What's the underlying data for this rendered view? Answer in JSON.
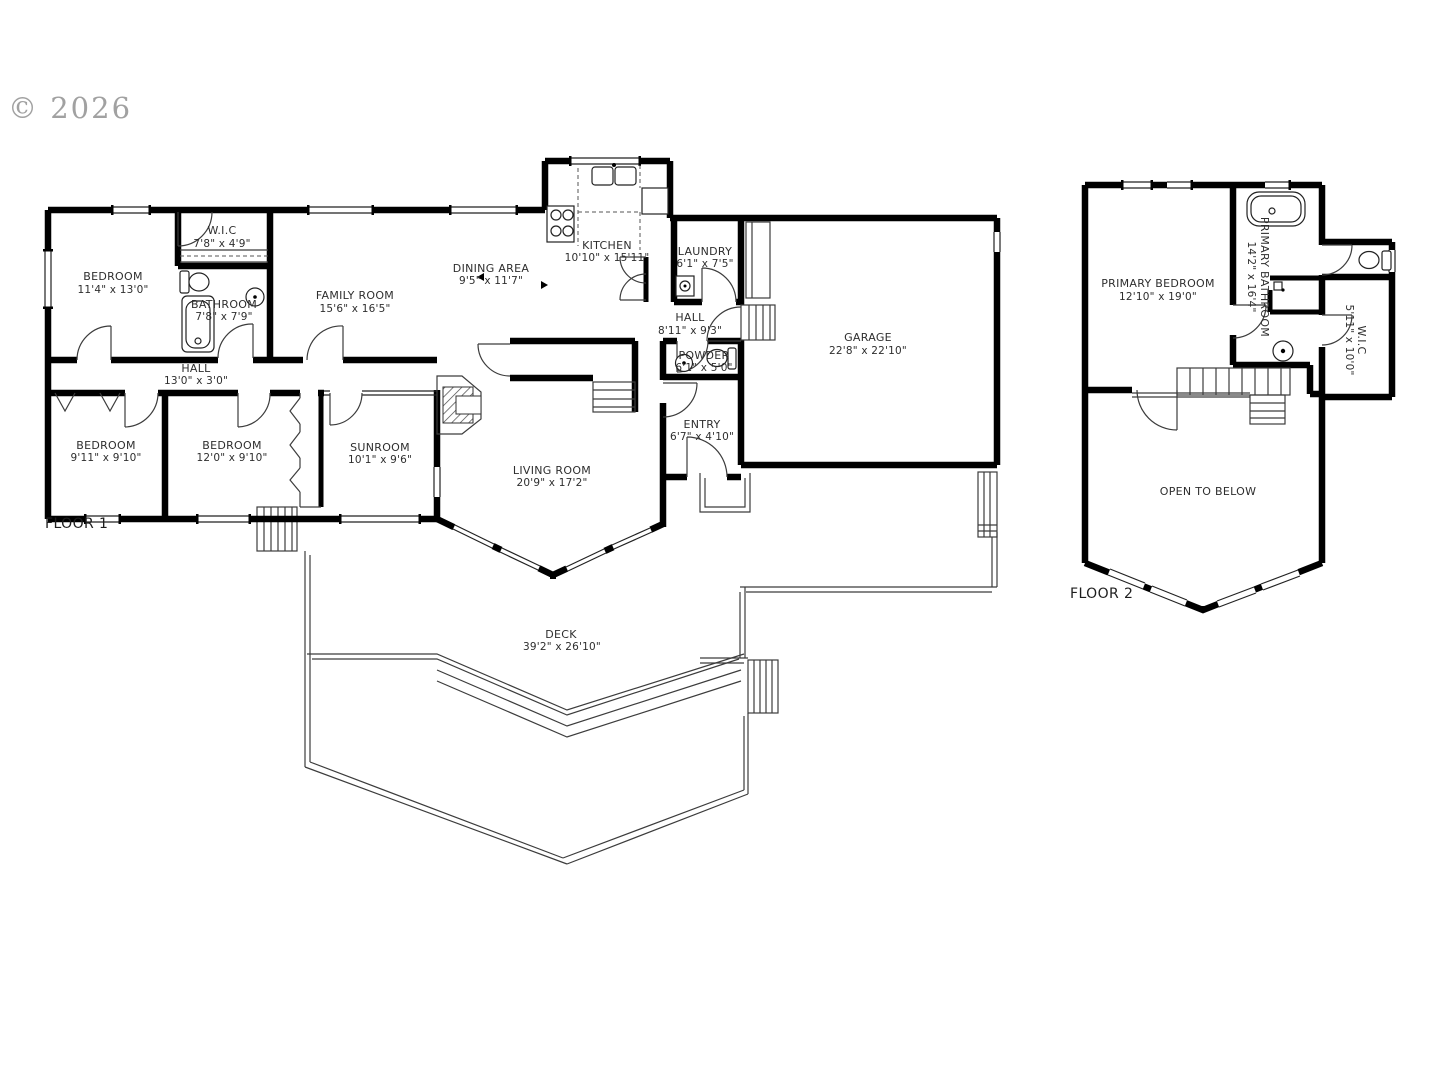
{
  "copyright": "© 2026",
  "floor1": {
    "label": "FLOOR 1",
    "rooms": {
      "bedroom1": {
        "name": "BEDROOM",
        "dims": "11'4\" x 13'0\""
      },
      "wic": {
        "name": "W.I.C",
        "dims": "7'8\" x 4'9\""
      },
      "bathroom": {
        "name": "BATHROOM",
        "dims": "7'8\" x 7'9\""
      },
      "family_room": {
        "name": "FAMILY ROOM",
        "dims": "15'6\" x 16'5\""
      },
      "dining_area": {
        "name": "DINING AREA",
        "dims": "9'5\" x 11'7\""
      },
      "kitchen": {
        "name": "KITCHEN",
        "dims": "10'10\" x 15'11\""
      },
      "laundry": {
        "name": "LAUNDRY",
        "dims": "6'1\" x 7'5\""
      },
      "hall_upper": {
        "name": "HALL",
        "dims": "8'11\" x 9'3\""
      },
      "powder": {
        "name": "POWDER",
        "dims": "6'1\" x 5'0\""
      },
      "garage": {
        "name": "GARAGE",
        "dims": "22'8\" x 22'10\""
      },
      "hall_lower": {
        "name": "HALL",
        "dims": "13'0\" x 3'0\""
      },
      "bedroom2": {
        "name": "BEDROOM",
        "dims": "9'11\" x 9'10\""
      },
      "bedroom3": {
        "name": "BEDROOM",
        "dims": "12'0\" x 9'10\""
      },
      "sunroom": {
        "name": "SUNROOM",
        "dims": "10'1\" x 9'6\""
      },
      "living_room": {
        "name": "LIVING ROOM",
        "dims": "20'9\" x 17'2\""
      },
      "entry": {
        "name": "ENTRY",
        "dims": "6'7\" x 4'10\""
      },
      "deck": {
        "name": "DECK",
        "dims": "39'2\" x 26'10\""
      }
    }
  },
  "floor2": {
    "label": "FLOOR 2",
    "rooms": {
      "primary_bedroom": {
        "name": "PRIMARY BEDROOM",
        "dims": "12'10\" x 19'0\""
      },
      "primary_bathroom": {
        "name": "PRIMARY BATHROOM",
        "dims": "14'2\" x 16'4\""
      },
      "wic": {
        "name": "W.I.C",
        "dims": "5'11\" x 10'0\""
      },
      "open_to_below": {
        "name": "OPEN TO BELOW"
      }
    }
  }
}
